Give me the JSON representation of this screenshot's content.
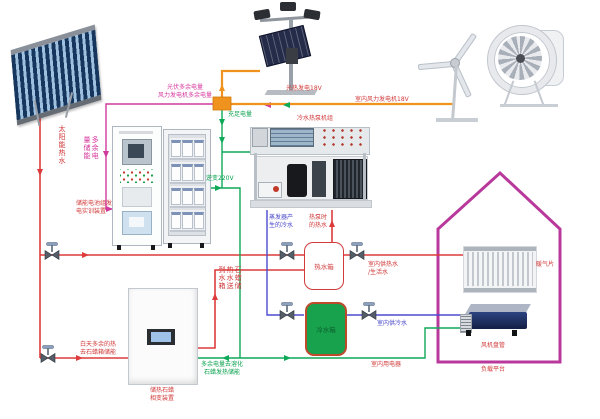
{
  "diagram": {
    "labels": {
      "pv_excess_1": "光伏多余电量",
      "pv_excess_2": "风力发电机多余电量",
      "surplus_storage": "多余电量储能",
      "storage_device_1": "储能电池组发",
      "storage_device_2": "电实训装置",
      "solar_hot": "太阳能热水",
      "sufficient": "充足电量",
      "inverter": "逆变220V",
      "pv_gen": "光热发电18V",
      "wind_gen": "室内风力发电机18V",
      "hp_title": "冷水热泵机组",
      "evap_1": "蒸发器产",
      "evap_2": "生的冷水",
      "hp_hot_1": "热泵时",
      "hp_hot_2": "的热水",
      "tank_hot": "热水箱",
      "tank_cold": "冷水箱",
      "paraffin_to_tank": "石蜡储热水送到水箱",
      "daytime_1": "白天多余的热",
      "daytime_2": "去石蜡箱储能",
      "paraffin_dev_1": "储热石蜡",
      "paraffin_dev_2": "相变装置",
      "melt_1": "多余电量去溶化",
      "melt_2": "石蜡发热储能",
      "indoor_hot_1": "室内供热水",
      "indoor_hot_2": "/生活水",
      "indoor_cold": "室内供冷水",
      "appliances": "室内用电器",
      "radiator": "暖气片",
      "fan_coil": "风机盘管",
      "platform": "负载平台"
    },
    "colors": {
      "hot_water_line": "#dd3b3b",
      "cold_water_line": "#4a4ad0",
      "power_line": "#0fa958",
      "excess_power_line": "#cf3a9c",
      "generation_line": "#f0921e",
      "house_outline": "#b8399b"
    }
  }
}
